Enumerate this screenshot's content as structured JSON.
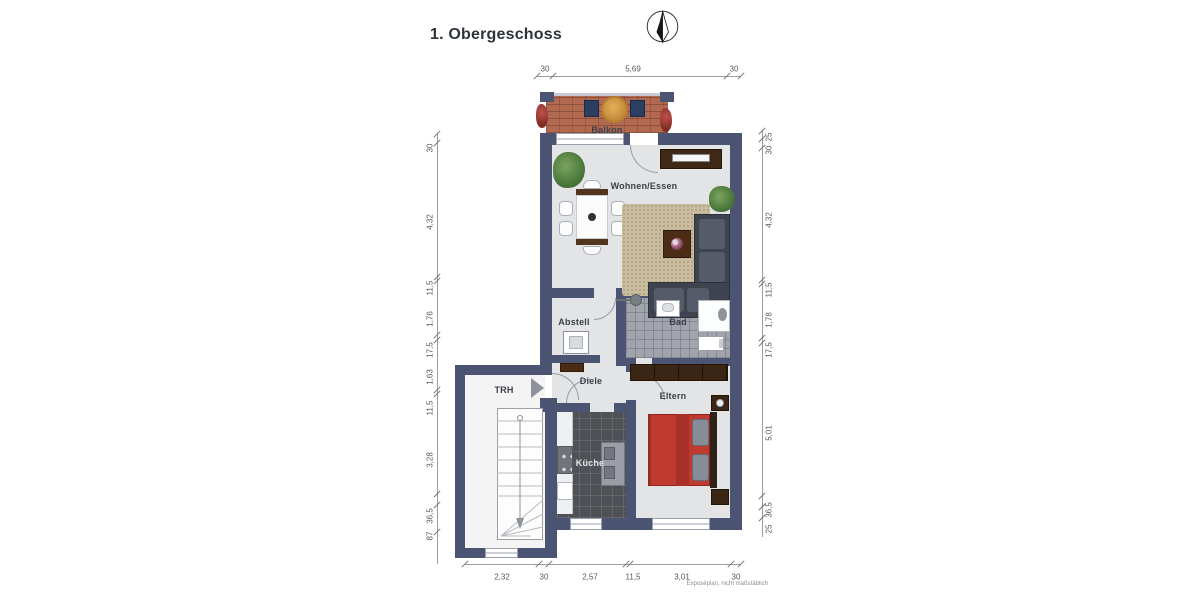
{
  "title": "1. Obergeschoss",
  "footer_note": "Exposéplan, nicht maßstäblich",
  "rooms": {
    "balkon": "Balkon",
    "wohnen_essen": "Wohnen/Essen",
    "abstell": "Abstell",
    "bad": "Bad",
    "diele": "Diele",
    "trh": "TRH",
    "kueche": "Küche",
    "eltern": "Eltern"
  },
  "dimensions": {
    "top": [
      "30",
      "5,69",
      "30"
    ],
    "left": [
      "30",
      "4,32",
      "11,5",
      "1,76",
      "17,5",
      "1,63",
      "11,5",
      "3,28",
      "36,5",
      "87"
    ],
    "right": [
      "25",
      "30",
      "4,32",
      "11,5",
      "1,78",
      "17,5",
      "5,01",
      "36,5",
      "25"
    ],
    "bottom": [
      "2,32",
      "30",
      "2,57",
      "11,5",
      "3,01",
      "30"
    ]
  },
  "icons": {
    "north_arrow": "compass-north-icon",
    "entrance_arrow": "entrance-direction-arrow-icon"
  },
  "colors": {
    "wall": "#4b5472",
    "floor": "#e3e4e6",
    "balcony_tile": "#b16a50",
    "bath_tile": "#a1a4ac",
    "kitchen_tile": "#505156",
    "bed": "#bf3a2f",
    "wood_dark": "#3f2815",
    "rug": "#c9bc9f",
    "sofa": "#3d434f"
  }
}
